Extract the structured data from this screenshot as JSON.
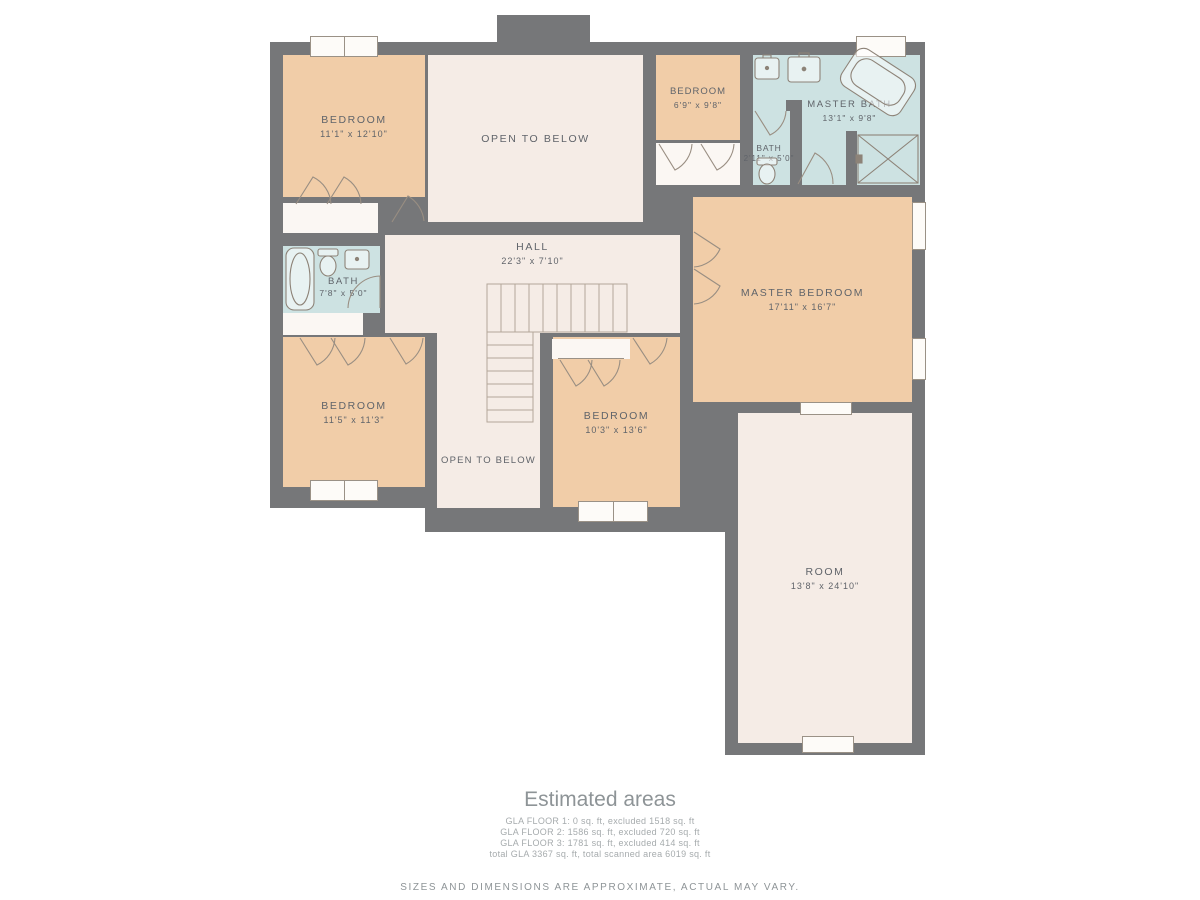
{
  "palette": {
    "wall": "#767779",
    "bedroom_fill": "#f1cda8",
    "open_area_fill": "#f5ece6",
    "bath_fill": "#cde2e2",
    "closet_fill": "#fbf7f3",
    "fixture_line": "#8d8378",
    "label_text": "#60646a",
    "footer_text": "#8e9497"
  },
  "rooms": [
    {
      "key": "bedroom-top-left",
      "name": "BEDROOM",
      "dims": "11'1\" x 12'10\""
    },
    {
      "key": "open-to-below-top",
      "name": "OPEN TO BELOW"
    },
    {
      "key": "bedroom-top",
      "name": "BEDROOM",
      "dims": "6'9\" x 9'8\""
    },
    {
      "key": "master-bath",
      "name": "MASTER BATH",
      "dims": "13'1\" x 9'8\""
    },
    {
      "key": "bath-small",
      "name": "BATH",
      "dims": "2'11\" x 5'0\""
    },
    {
      "key": "hall",
      "name": "HALL",
      "dims": "22'3\" x 7'10\""
    },
    {
      "key": "bath",
      "name": "BATH",
      "dims": "7'8\" x 5'0\""
    },
    {
      "key": "master-bedroom",
      "name": "MASTER BEDROOM",
      "dims": "17'11\" x 16'7\""
    },
    {
      "key": "bedroom-bottom-left",
      "name": "BEDROOM",
      "dims": "11'5\" x 11'3\""
    },
    {
      "key": "open-to-below-bottom",
      "name": "OPEN TO BELOW"
    },
    {
      "key": "bedroom-bottom-middle",
      "name": "BEDROOM",
      "dims": "10'3\" x 13'6\""
    },
    {
      "key": "room",
      "name": "ROOM",
      "dims": "13'8\" x 24'10\""
    }
  ],
  "footer": {
    "title": "Estimated areas",
    "lines": [
      "GLA FLOOR 1: 0 sq. ft, excluded 1518 sq. ft",
      "GLA FLOOR 2: 1586 sq. ft, excluded 720 sq. ft",
      "GLA FLOOR 3: 1781 sq. ft, excluded 414 sq. ft",
      "total GLA 3367 sq. ft, total scanned area 6019 sq. ft"
    ],
    "disclaimer": "SIZES AND DIMENSIONS ARE APPROXIMATE, ACTUAL MAY VARY."
  }
}
